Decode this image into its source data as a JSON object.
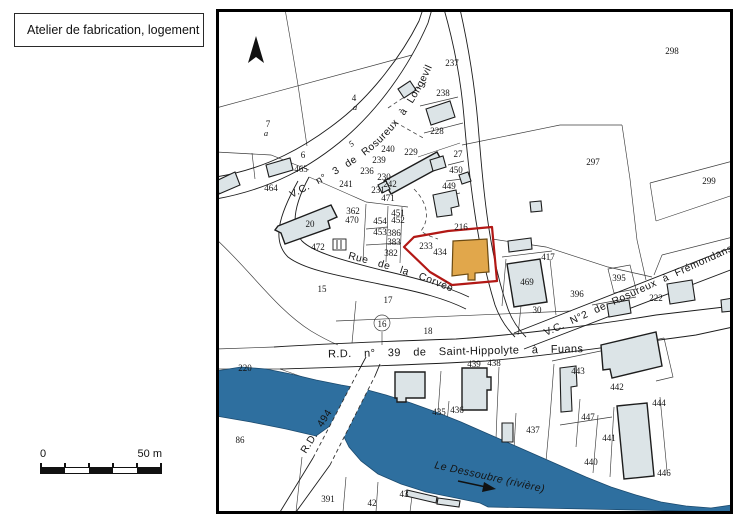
{
  "title_box": {
    "label": "Atelier de fabrication, logement"
  },
  "scale_bar": {
    "start": "0",
    "end": "50 m"
  },
  "map": {
    "colors": {
      "river": "#2e6f9f",
      "building": "#dce4e7",
      "highlight_building": "#e1a74b",
      "highlight_outline": "#b21815"
    },
    "roads": {
      "vc3": "V.C. n° 3 de Rosureux à Longeville",
      "corvee": "Rue de la Corvée",
      "vc2": "V.C. N°2 de Rosureux à Frémondans",
      "rd39": "R.D. n° 39 de Saint-Hippolyte à Fuans",
      "rd494": "R.D. 494",
      "river": "Le Dessoubre (rivière)"
    },
    "parcels": {
      "p298": "298",
      "p237": "237",
      "p238": "238",
      "p4": "4",
      "p4a": "a",
      "p7": "7",
      "p7a": "a",
      "p228": "228",
      "p297": "297",
      "p299": "299",
      "p6": "6",
      "p465": "465",
      "p464": "464",
      "p240": "240",
      "p239": "239",
      "p229": "229",
      "p27": "27",
      "p236": "236",
      "p450": "450",
      "p241": "241",
      "p230": "230",
      "p242": "242",
      "p231": "231",
      "p471": "471",
      "p449": "449",
      "p362": "362",
      "p470": "470",
      "p451": "451",
      "p452": "452",
      "p454": "454",
      "p453": "453",
      "p386": "386",
      "p383": "383",
      "p382": "382",
      "p20": "20",
      "p472": "472",
      "p216": "216",
      "p233": "233",
      "p434": "434",
      "p417": "417",
      "p395": "395",
      "p396": "396",
      "p222": "222",
      "p469": "469",
      "p30": "30",
      "p15": "15",
      "p17": "17",
      "p16": "16",
      "p18": "18",
      "p220": "220",
      "p86": "86",
      "p439": "439",
      "p438": "438",
      "p443": "443",
      "p442": "442",
      "p444": "444",
      "p447": "447",
      "p441": "441",
      "p440": "440",
      "p446": "446",
      "p435": "435",
      "p436": "436",
      "p437": "437",
      "p391": "391",
      "p42": "42",
      "p43": "43",
      "p5": "5"
    }
  }
}
